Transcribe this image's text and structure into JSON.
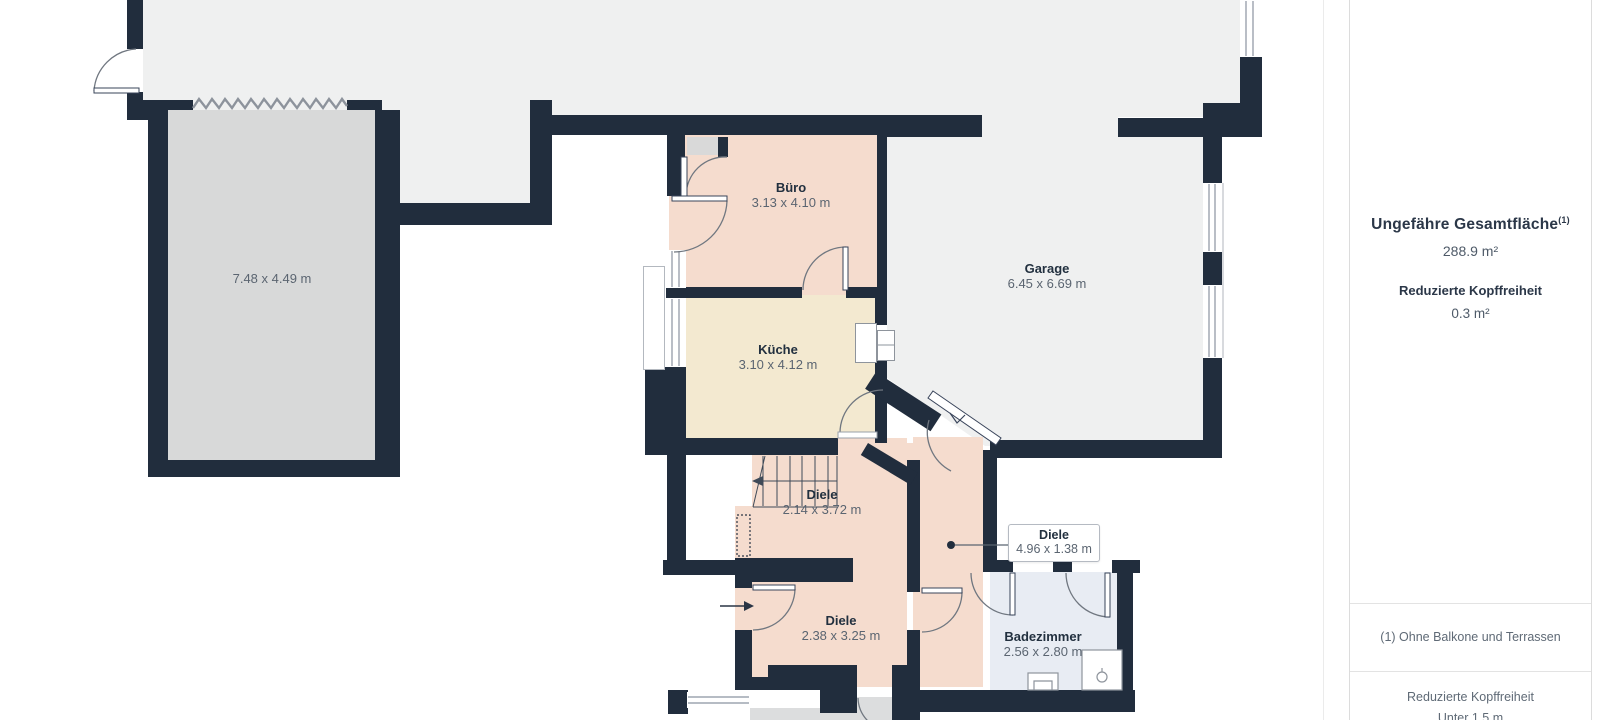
{
  "plan": {
    "rooms": [
      {
        "name": "",
        "dims": "7.48 x 4.49 m",
        "x": 272,
        "y": 271
      },
      {
        "name": "Büro",
        "dims": "3.13 x 4.10 m",
        "x": 791,
        "y": 180
      },
      {
        "name": "Garage",
        "dims": "6.45 x 6.69 m",
        "x": 1047,
        "y": 261
      },
      {
        "name": "Küche",
        "dims": "3.10 x 4.12 m",
        "x": 778,
        "y": 342
      },
      {
        "name": "Diele",
        "dims": "2.14 x 3.72 m",
        "x": 822,
        "y": 487
      },
      {
        "name": "Diele",
        "dims": "2.38 x 3.25 m",
        "x": 841,
        "y": 613
      },
      {
        "name": "Badezimmer",
        "dims": "2.56 x 2.80 m",
        "x": 1043,
        "y": 629
      }
    ],
    "callout": {
      "name": "Diele",
      "dims": "4.96 x 1.38 m"
    }
  },
  "sidebar": {
    "total_area_label": "Ungefähre Gesamtfläche",
    "total_area_superscript": "(1)",
    "total_area_value": "288.9 m²",
    "reduced_headroom_label": "Reduzierte Kopffreiheit",
    "reduced_headroom_value": "0.3 m²",
    "footnote": "(1) Ohne Balkone und Terrassen",
    "legend_title": "Reduzierte Kopffreiheit",
    "legend_value": "Unter 1.5 m"
  },
  "colors": {
    "wall": "#212d3d",
    "interior_gray": "#eff0f0",
    "terrace_gray": "#d8d9d9",
    "room_pink": "#f5dcce",
    "room_cream": "#f3e9d0",
    "room_blue": "#e8ecf3",
    "label_dark": "#22303f",
    "label_gray": "#5b6571"
  }
}
